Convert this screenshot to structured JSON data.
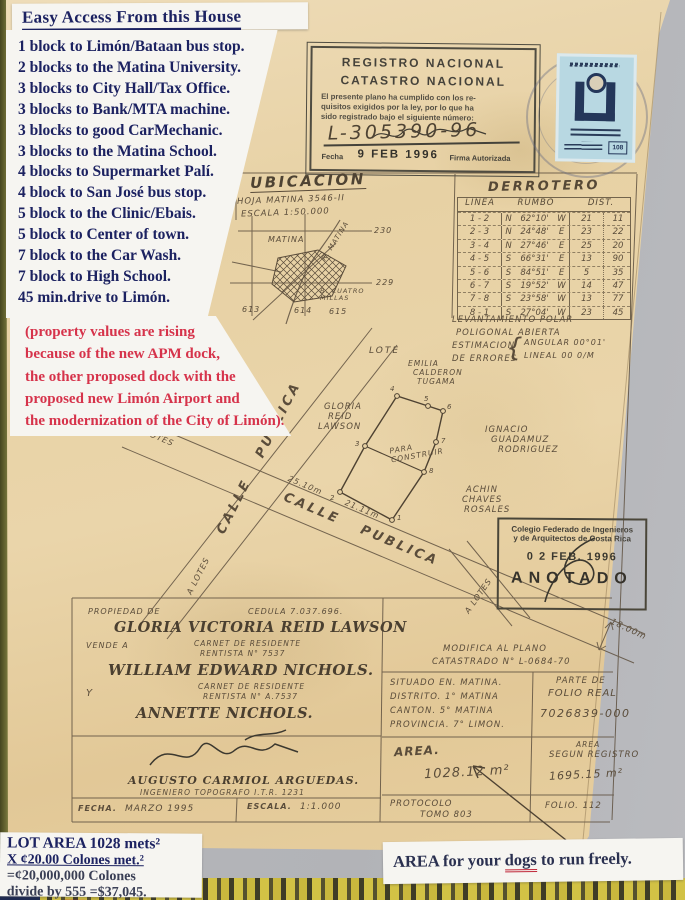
{
  "colors": {
    "navy": "#1c2261",
    "red": "#d6334b",
    "ink": "#5a4c3a",
    "paper": "#e7d1a4",
    "stamp_blue": "#b8d8e2"
  },
  "title_note": "Easy Access From this House",
  "access_list": [
    "1 block to Limón/Bataan bus stop.",
    "2 blocks to the Matina University.",
    "3 blocks to City Hall/Tax Office.",
    "3 blocks to Bank/MTA machine.",
    "3 blocks to good CarMechanic.",
    "3 blocks to the Matina School.",
    "4 blocks to Supermarket Palí.",
    "4 block to San José bus stop.",
    "5 block to the Clinic/Ebais.",
    "5 block to Center of town.",
    "7 block to the Car Wash.",
    "7 block to  High School.",
    "45 min.drive to Limón."
  ],
  "red_note_lines": [
    "(property values are rising",
    "because of the new APM dock,",
    "the other proposed dock with the",
    "proposed new Limón Airport and",
    "the modernization of the City of Limón)."
  ],
  "lot_area": {
    "l1": "LOT AREA 1028 mets²",
    "l2": "X ¢20.00 Colones met.²",
    "l3": "=¢20,000,000 Colones",
    "l4_pre": "divide by ",
    "l4_num": "555",
    "l4_post": " =$37,045."
  },
  "dogs_note": {
    "pre": "AREA for your ",
    "word": "dogs",
    "post": " to run freely."
  },
  "registro_stamp": {
    "line1": "REGISTRO NACIONAL",
    "line2": "CATASTRO NACIONAL",
    "b1": "El presente plano ha cumplido con los re-",
    "b2": "quisitos exigidos por la ley, por lo que ha",
    "b3": "sido registrado bajo el siguiente número:",
    "number": "L-305390-96",
    "fecha_label": "Fecha",
    "fecha_value": "9 FEB 1996",
    "firma": "Firma Autorizada"
  },
  "fiscal_stamp": {
    "value": "108"
  },
  "ubicacion": {
    "title": "UBICACION",
    "hoja": "HOJA MATINA 3546-II",
    "escala": "ESCALA 1:50.000",
    "town": "MATINA",
    "river": "R. MATINA",
    "village": "B. CUATRO MILLAS",
    "n230": "230",
    "n229": "229",
    "n613": "613",
    "n614": "614",
    "n615": "615"
  },
  "derrotero": {
    "title": "DERROTERO",
    "h_linea": "LINEA",
    "h_rumbo": "RUMBO",
    "h_dist": "DIST.",
    "rows": [
      [
        "1 - 2",
        "N",
        "62°10'",
        "W",
        "21",
        "11"
      ],
      [
        "2 - 3",
        "N",
        "24°48'",
        "E",
        "23",
        "22"
      ],
      [
        "3 - 4",
        "N",
        "27°46'",
        "E",
        "25",
        "20"
      ],
      [
        "4 - 5",
        "S",
        "66°31'",
        "E",
        "13",
        "90"
      ],
      [
        "5 - 6",
        "S",
        "84°51'",
        "E",
        "5",
        "35"
      ],
      [
        "6 - 7",
        "S",
        "19°52'",
        "W",
        "14",
        "47"
      ],
      [
        "7 - 8",
        "S",
        "23°58'",
        "W",
        "13",
        "77"
      ],
      [
        "8 - 1",
        "S",
        "27°04'",
        "W",
        "23",
        "45"
      ]
    ]
  },
  "levantamiento": {
    "l1": "LEVANTAMIENTO POLAR",
    "l2": "POLIGONAL ABIERTA",
    "l3": "ESTIMACION",
    "l4": "DE ERRORES",
    "e1": "ANGULAR 00°01'",
    "e2": "LINEAL 00 0/M"
  },
  "map": {
    "lote": "LOTE",
    "neighbor_top": [
      "EMILIA",
      "CALDERON",
      "TUGAMA"
    ],
    "neighbor_right": [
      "IGNACIO",
      "GUADAMUZ",
      "RODRIGUEZ"
    ],
    "neighbor_bottom": [
      "ACHIN",
      "CHAVES",
      "ROSALES"
    ],
    "owner_left": [
      "GLORIA",
      "REID",
      "LAWSON"
    ],
    "para_construir": "PARA CONSTRUIR",
    "calle_publica": "CALLE PUBLICA",
    "a_lotes": "A LOTES",
    "dim_25": "25.10m",
    "dim_21": "21.11m",
    "dim_18": "18.00m",
    "vertices": [
      "1",
      "2",
      "3",
      "4",
      "5",
      "6",
      "7",
      "8"
    ]
  },
  "colegio_stamp": {
    "l1": "Colegio Federado de Ingenieros",
    "l2": "y de Arquitectos de Costa Rica",
    "date": "0 2 FEB. 1996",
    "anotado": "ANOTADO"
  },
  "owner_block": {
    "propiedad_label": "PROPIEDAD DE",
    "cedula": "CEDULA 7.037.696.",
    "owner": "GLORIA VICTORIA REID LAWSON",
    "vende_label": "VENDE A",
    "carnet1_l1": "CARNET DE RESIDENTE",
    "carnet1_l2": "RENTISTA N° 7537",
    "buyer1": "WILLIAM EDWARD NICHOLS.",
    "y_label": "Y",
    "carnet2_l1": "CARNET DE RESIDENTE",
    "carnet2_l2": "RENTISTA N° A.7537",
    "buyer2": "ANNETTE NICHOLS.",
    "engineer": "AUGUSTO CARMIOL ARGUEDAS.",
    "engineer_title": "INGENIERO TOPOGRAFO I.T.R. 1231",
    "fecha_label": "FECHA.",
    "fecha": "MARZO 1995",
    "escala_label": "ESCALA.",
    "escala": "1:1.000"
  },
  "info_block": {
    "modifica_l1": "MODIFICA AL PLANO",
    "modifica_l2": "CATASTRADO N° L-0684-70",
    "situado": "SITUADO EN.  MATINA.",
    "distrito": "DISTRITO.  1° MATINA",
    "canton": "CANTON.  5° MATINA",
    "provincia": "PROVINCIA.  7° LIMON.",
    "parte_l1": "PARTE DE",
    "parte_l2": "FOLIO REAL",
    "folio_real": "7026839-000",
    "area_label": "AREA.",
    "area_value": "1028.12 m²",
    "area_reg_l1": "AREA",
    "area_reg_l2": "SEGUN REGISTRO",
    "area_reg_value": "1695.15 m²",
    "protocolo_l1": "PROTOCOLO",
    "protocolo_l2": "TOMO 803",
    "folio": "FOLIO. 112"
  }
}
